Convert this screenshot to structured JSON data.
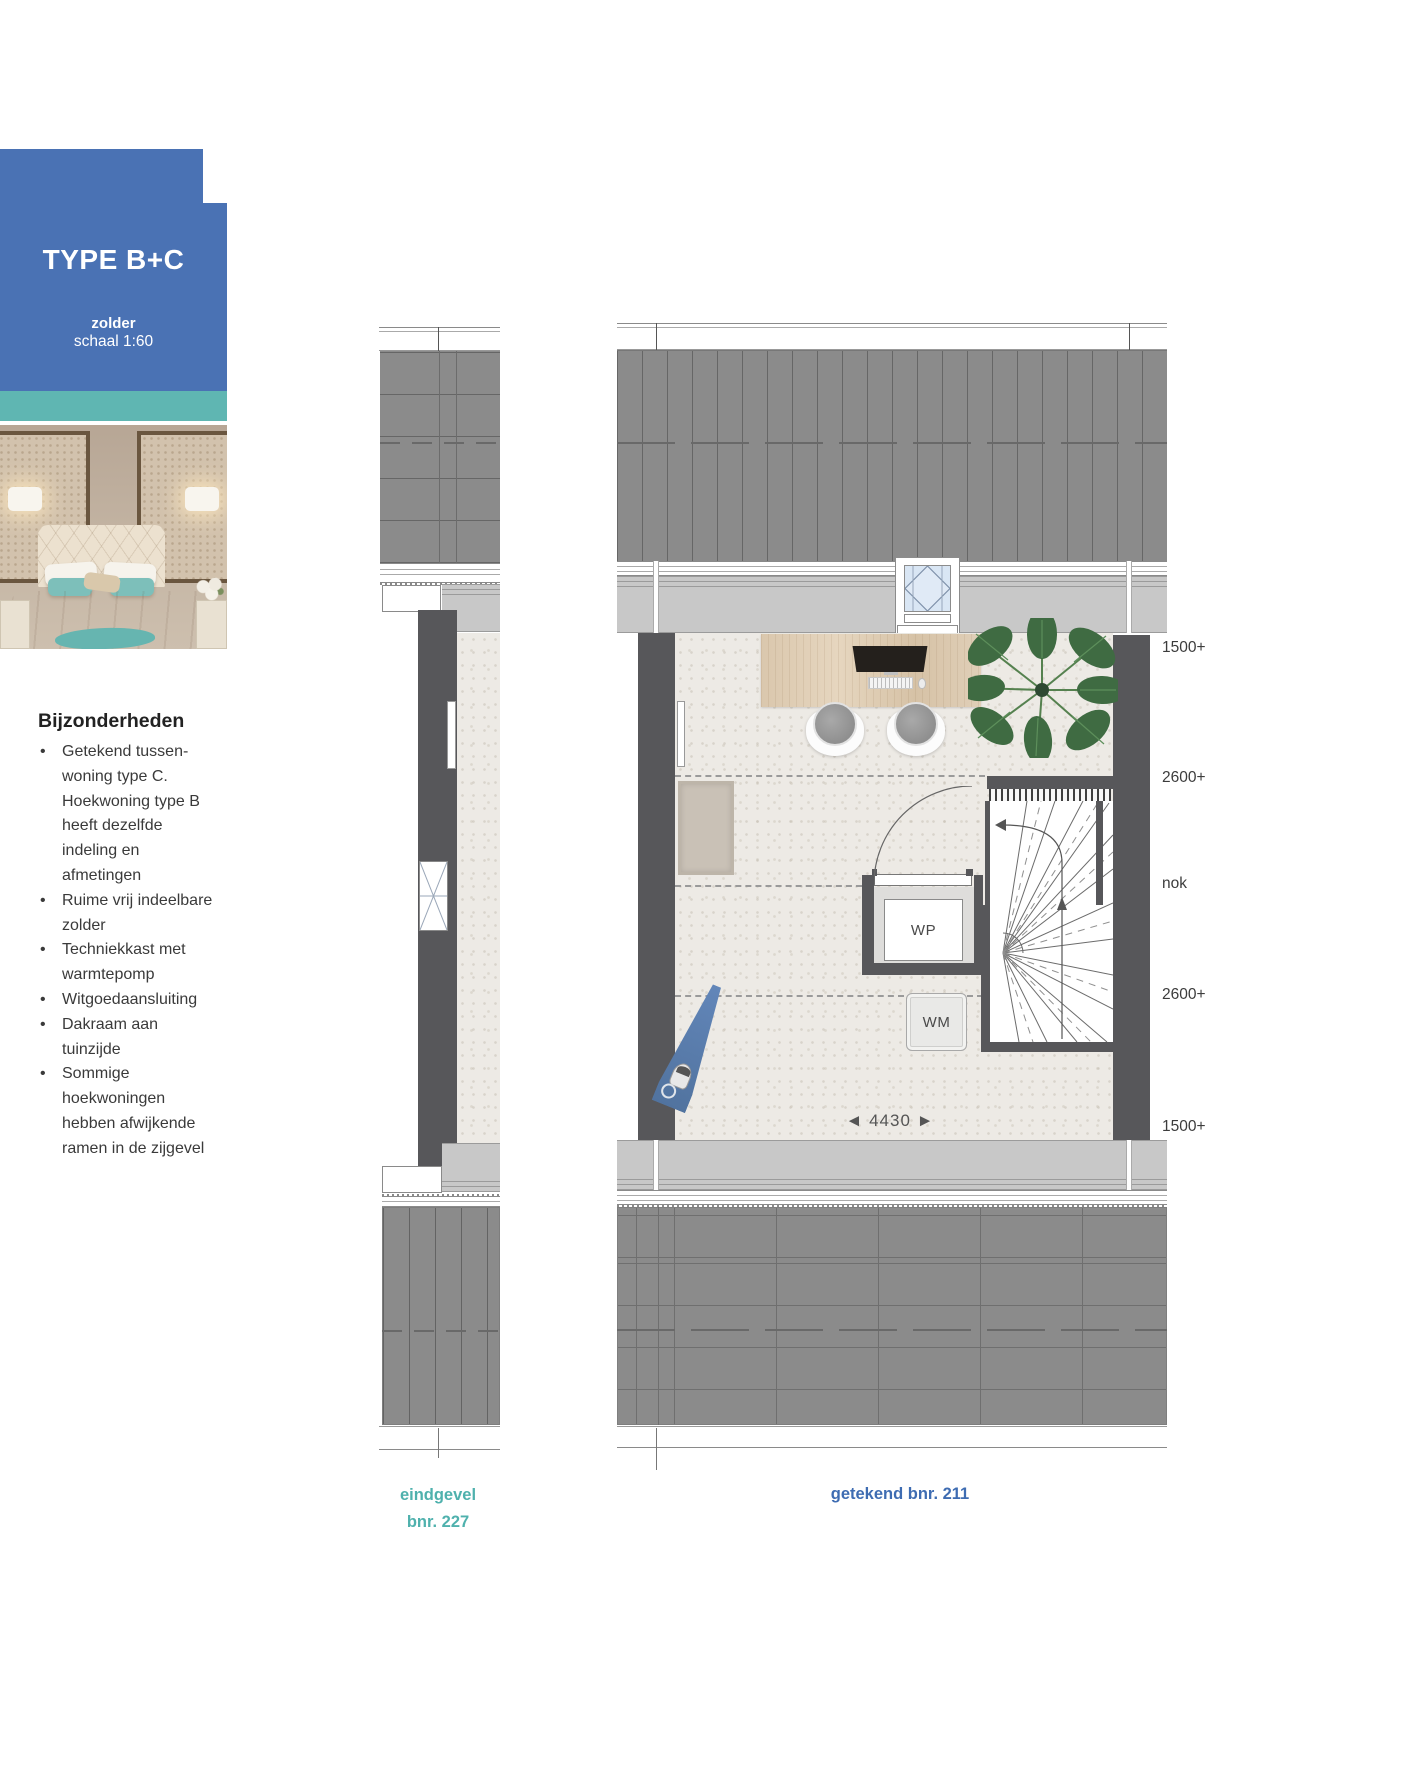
{
  "header_card": {
    "title": "TYPE B+C",
    "floor_label": "zolder",
    "scale_label": "schaal 1:60"
  },
  "details": {
    "heading": "Bijzonderheden",
    "items": [
      "Getekend tussen-woning type C. Hoekwoning type B heeft dezelfde indeling en afmetingen",
      "Ruime vrij indeelbare zolder",
      "Techniekkast met warmtepomp",
      "Witgoedaansluiting",
      "Dakraam aan tuinzijde",
      "Sommige hoekwoningen hebben afwijkende ramen in de zijgevel"
    ]
  },
  "plan": {
    "height_labels": [
      "1500+",
      "2600+",
      "nok",
      "2600+",
      "1500+"
    ],
    "width_dim": {
      "arrow_left": "◄",
      "value": "4430",
      "arrow_right": "►"
    },
    "room_labels": {
      "wp": "WP",
      "wm": "WM"
    }
  },
  "captions": {
    "left_line1": "eindgevel",
    "left_line2": "bnr. 227",
    "right": "getekend bnr. 211"
  },
  "colors": {
    "card_blue": "#4a72b4",
    "stripe_teal": "#5fb6b2",
    "caption_teal": "#4fb1ad",
    "caption_blue": "#3e6cb2",
    "roof_gray": "#8b8b8b",
    "wall_gray": "#c8c8c8",
    "dark_wall": "#57575a",
    "floor_cream": "#edeae5",
    "ironing_board_blue": "#5d80b4"
  }
}
